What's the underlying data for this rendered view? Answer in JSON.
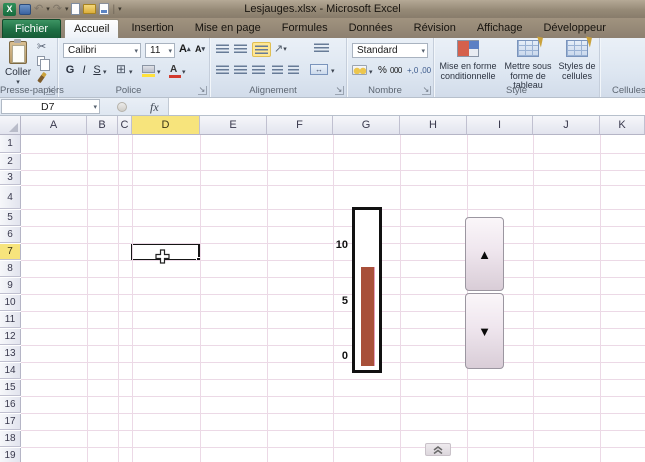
{
  "title_bar": {
    "title": "Lesjauges.xlsx - Microsoft Excel"
  },
  "tabs": {
    "file": "Fichier",
    "items": [
      {
        "label": "Accueil",
        "active": true
      },
      {
        "label": "Insertion",
        "active": false
      },
      {
        "label": "Mise en page",
        "active": false
      },
      {
        "label": "Formules",
        "active": false
      },
      {
        "label": "Données",
        "active": false
      },
      {
        "label": "Révision",
        "active": false
      },
      {
        "label": "Affichage",
        "active": false
      },
      {
        "label": "Développeur",
        "active": false
      }
    ]
  },
  "ribbon": {
    "clipboard": {
      "group_label": "Presse-papiers",
      "paste": "Coller"
    },
    "font": {
      "group_label": "Police",
      "name": "Calibri",
      "size": "11",
      "bold": "G",
      "italic": "I",
      "underline": "S",
      "grow": "A",
      "shrink": "A"
    },
    "alignment": {
      "group_label": "Alignement"
    },
    "number": {
      "group_label": "Nombre",
      "format": "Standard"
    },
    "style": {
      "group_label": "Style",
      "conditional": "Mise en forme conditionnelle",
      "format_table": "Mettre sous forme de tableau",
      "cell_styles": "Styles de cellules"
    },
    "cells": {
      "group_label": "Cellules",
      "insert": "Insérer",
      "delete": "Supprimer",
      "format": "Format"
    }
  },
  "icons": {
    "caret_down": "▾",
    "scissors": "✂",
    "undo": "↶",
    "redo": "↷",
    "borders": "⊞",
    "percent": "%",
    "thousands": "000",
    "increase_decimal": "+,0",
    "decrease_decimal": ",00",
    "orientation": "↗",
    "merge_arrows": "↔",
    "launcher": "↘",
    "fx": "fx",
    "chevrons_up": "«"
  },
  "formula_bar": {
    "name_box": "D7",
    "value": ""
  },
  "sheet": {
    "columns": [
      "A",
      "B",
      "C",
      "D",
      "E",
      "F",
      "G",
      "H",
      "I",
      "J",
      "K"
    ],
    "rows": [
      "1",
      "2",
      "3",
      "4",
      "5",
      "6",
      "7",
      "8",
      "9",
      "10",
      "11",
      "12",
      "13",
      "14",
      "15",
      "16",
      "17",
      "18",
      "19"
    ],
    "selected": {
      "cell": "D7",
      "col": "D",
      "row": "7"
    }
  },
  "chart_data": {
    "type": "bar",
    "title": "",
    "values": [
      8
    ],
    "yticks": [
      0,
      5,
      10
    ],
    "ylim": [
      0,
      12
    ],
    "bar_color": "#a8503a",
    "orientation": "vertical-thermometer",
    "grid": false,
    "legend": false
  },
  "spin_button": {
    "up_icon": "▲",
    "down_icon": "▼"
  }
}
